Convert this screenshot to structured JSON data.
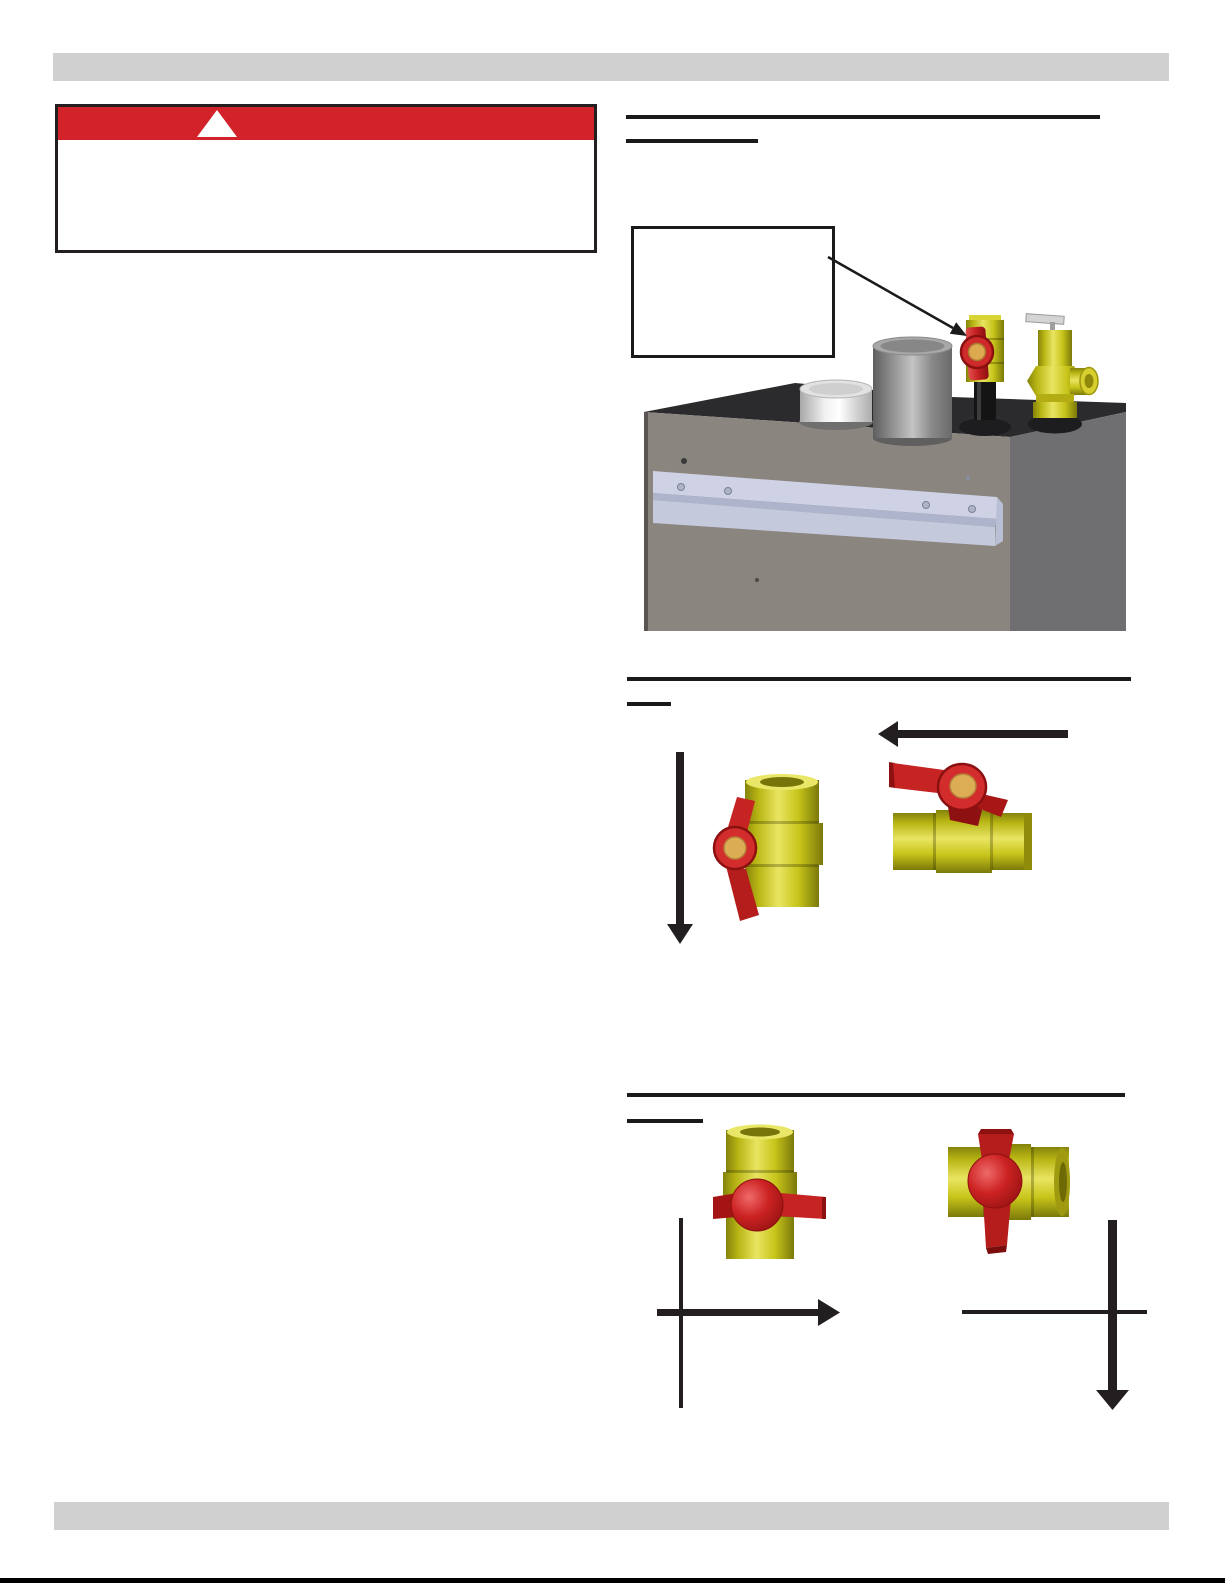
{
  "page": {
    "background": "#ffffff",
    "top_band_color": "#d0d0d0",
    "bottom_band_color": "#d0d0d0",
    "bottom_rule_color": "#000000"
  },
  "warning_box": {
    "banner_color": "#d2232a",
    "border_color": "#231f20",
    "icon": "warning-triangle-icon",
    "icon_color": "#ffffff",
    "body_text": ""
  },
  "section_shutoff": {
    "heading_text": "",
    "subheading_text": "",
    "callout": {
      "text": "",
      "points_to": "shutoff-valve"
    },
    "figure_parts": [
      "vent-collar",
      "vent-pipe",
      "shutoff-valve",
      "relief-valve",
      "mounting-bracket",
      "boiler-cabinet"
    ]
  },
  "section_open_position": {
    "heading_text": "",
    "subheading_text": "",
    "valves": [
      {
        "body": "vertical",
        "handle": "parallel-to-pipe",
        "flow_arrow": "down"
      },
      {
        "body": "horizontal",
        "handle": "parallel-to-pipe",
        "flow_arrow": "left"
      }
    ]
  },
  "section_closed_position": {
    "heading_text": "",
    "subheading_text": "",
    "valves": [
      {
        "body": "vertical",
        "handle": "perpendicular-to-pipe",
        "flow_arrow": "right"
      },
      {
        "body": "horizontal",
        "handle": "perpendicular-to-pipe",
        "flow_arrow": "down"
      }
    ]
  },
  "colors": {
    "brass_yellow": "#c7c41a",
    "handle_red": "#c62525",
    "handle_hole_tan": "#ddad55",
    "boiler_front": "#8b8580",
    "boiler_side": "#6f6f72",
    "boiler_top": "#2b2b2d",
    "bracket_silver": "#ced2e4",
    "arrow_black": "#231f20"
  }
}
